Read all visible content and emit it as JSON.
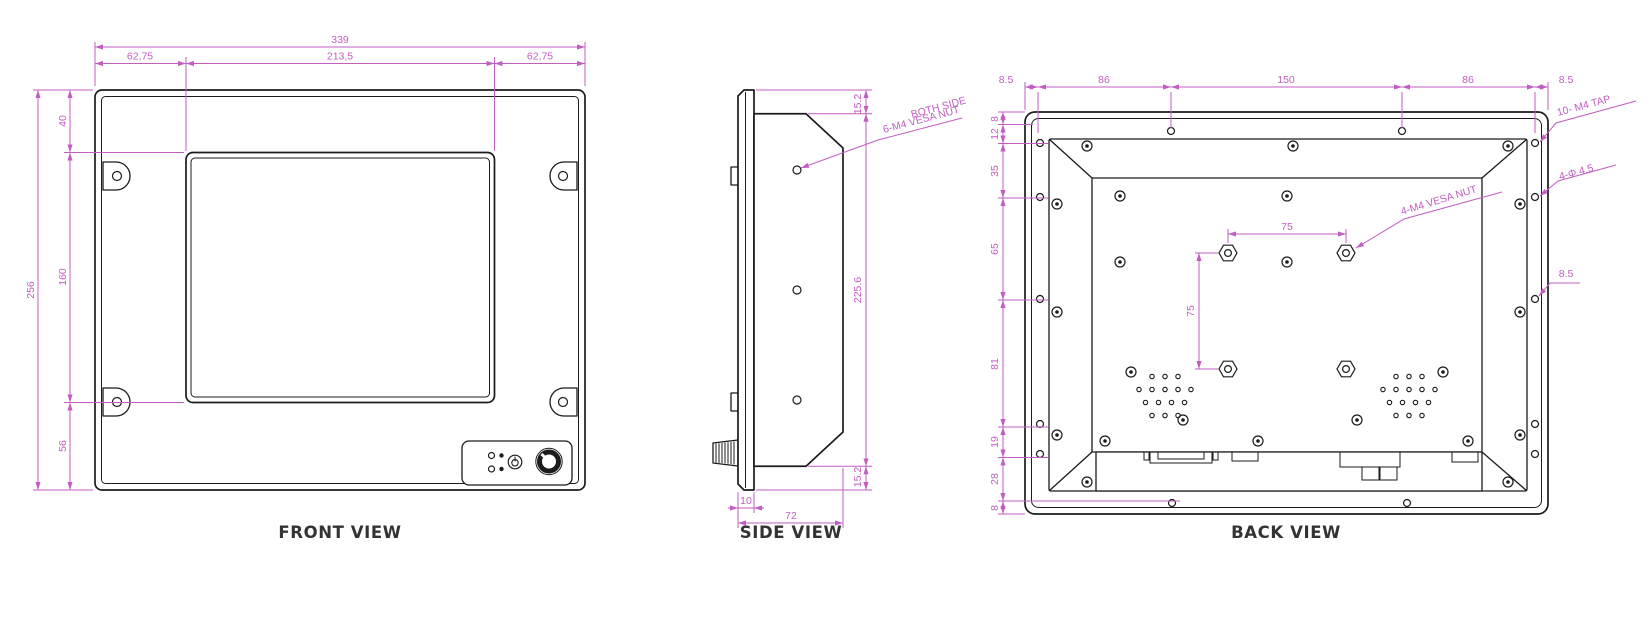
{
  "palette": {
    "dimension_color": "#c25ec2",
    "line_color": "#1b1b1b",
    "caption_color": "#333333",
    "background": "#ffffff"
  },
  "front": {
    "caption": "FRONT VIEW",
    "width_total": "339",
    "width_left": "62,75",
    "width_screen": "213,5",
    "width_right": "62,75",
    "height_total": "256",
    "height_top": "40",
    "height_screen": "160",
    "height_bottom": "56"
  },
  "side": {
    "caption": "SIDE VIEW",
    "thickness_top": "15.2",
    "thickness_body": "225.6",
    "thickness_bottom": "15.2",
    "bezel_depth": "10",
    "total_depth": "72",
    "label_line1": "BOTH SIDE",
    "label_line2": "6-M4 VESA NUT"
  },
  "back": {
    "caption": "BACK VIEW",
    "top_chain": [
      "8.5",
      "86",
      "150",
      "86",
      "8.5"
    ],
    "left_chain": [
      "8",
      "12",
      "35",
      "65",
      "81",
      "19",
      "28",
      "8"
    ],
    "vesa_width": "75",
    "vesa_height": "75",
    "edge_offset": "8.5",
    "label_vesa": "4-M4 VESA NUT",
    "label_tap": "10- M4 TAP",
    "label_hole": "4-Φ 4.5"
  }
}
